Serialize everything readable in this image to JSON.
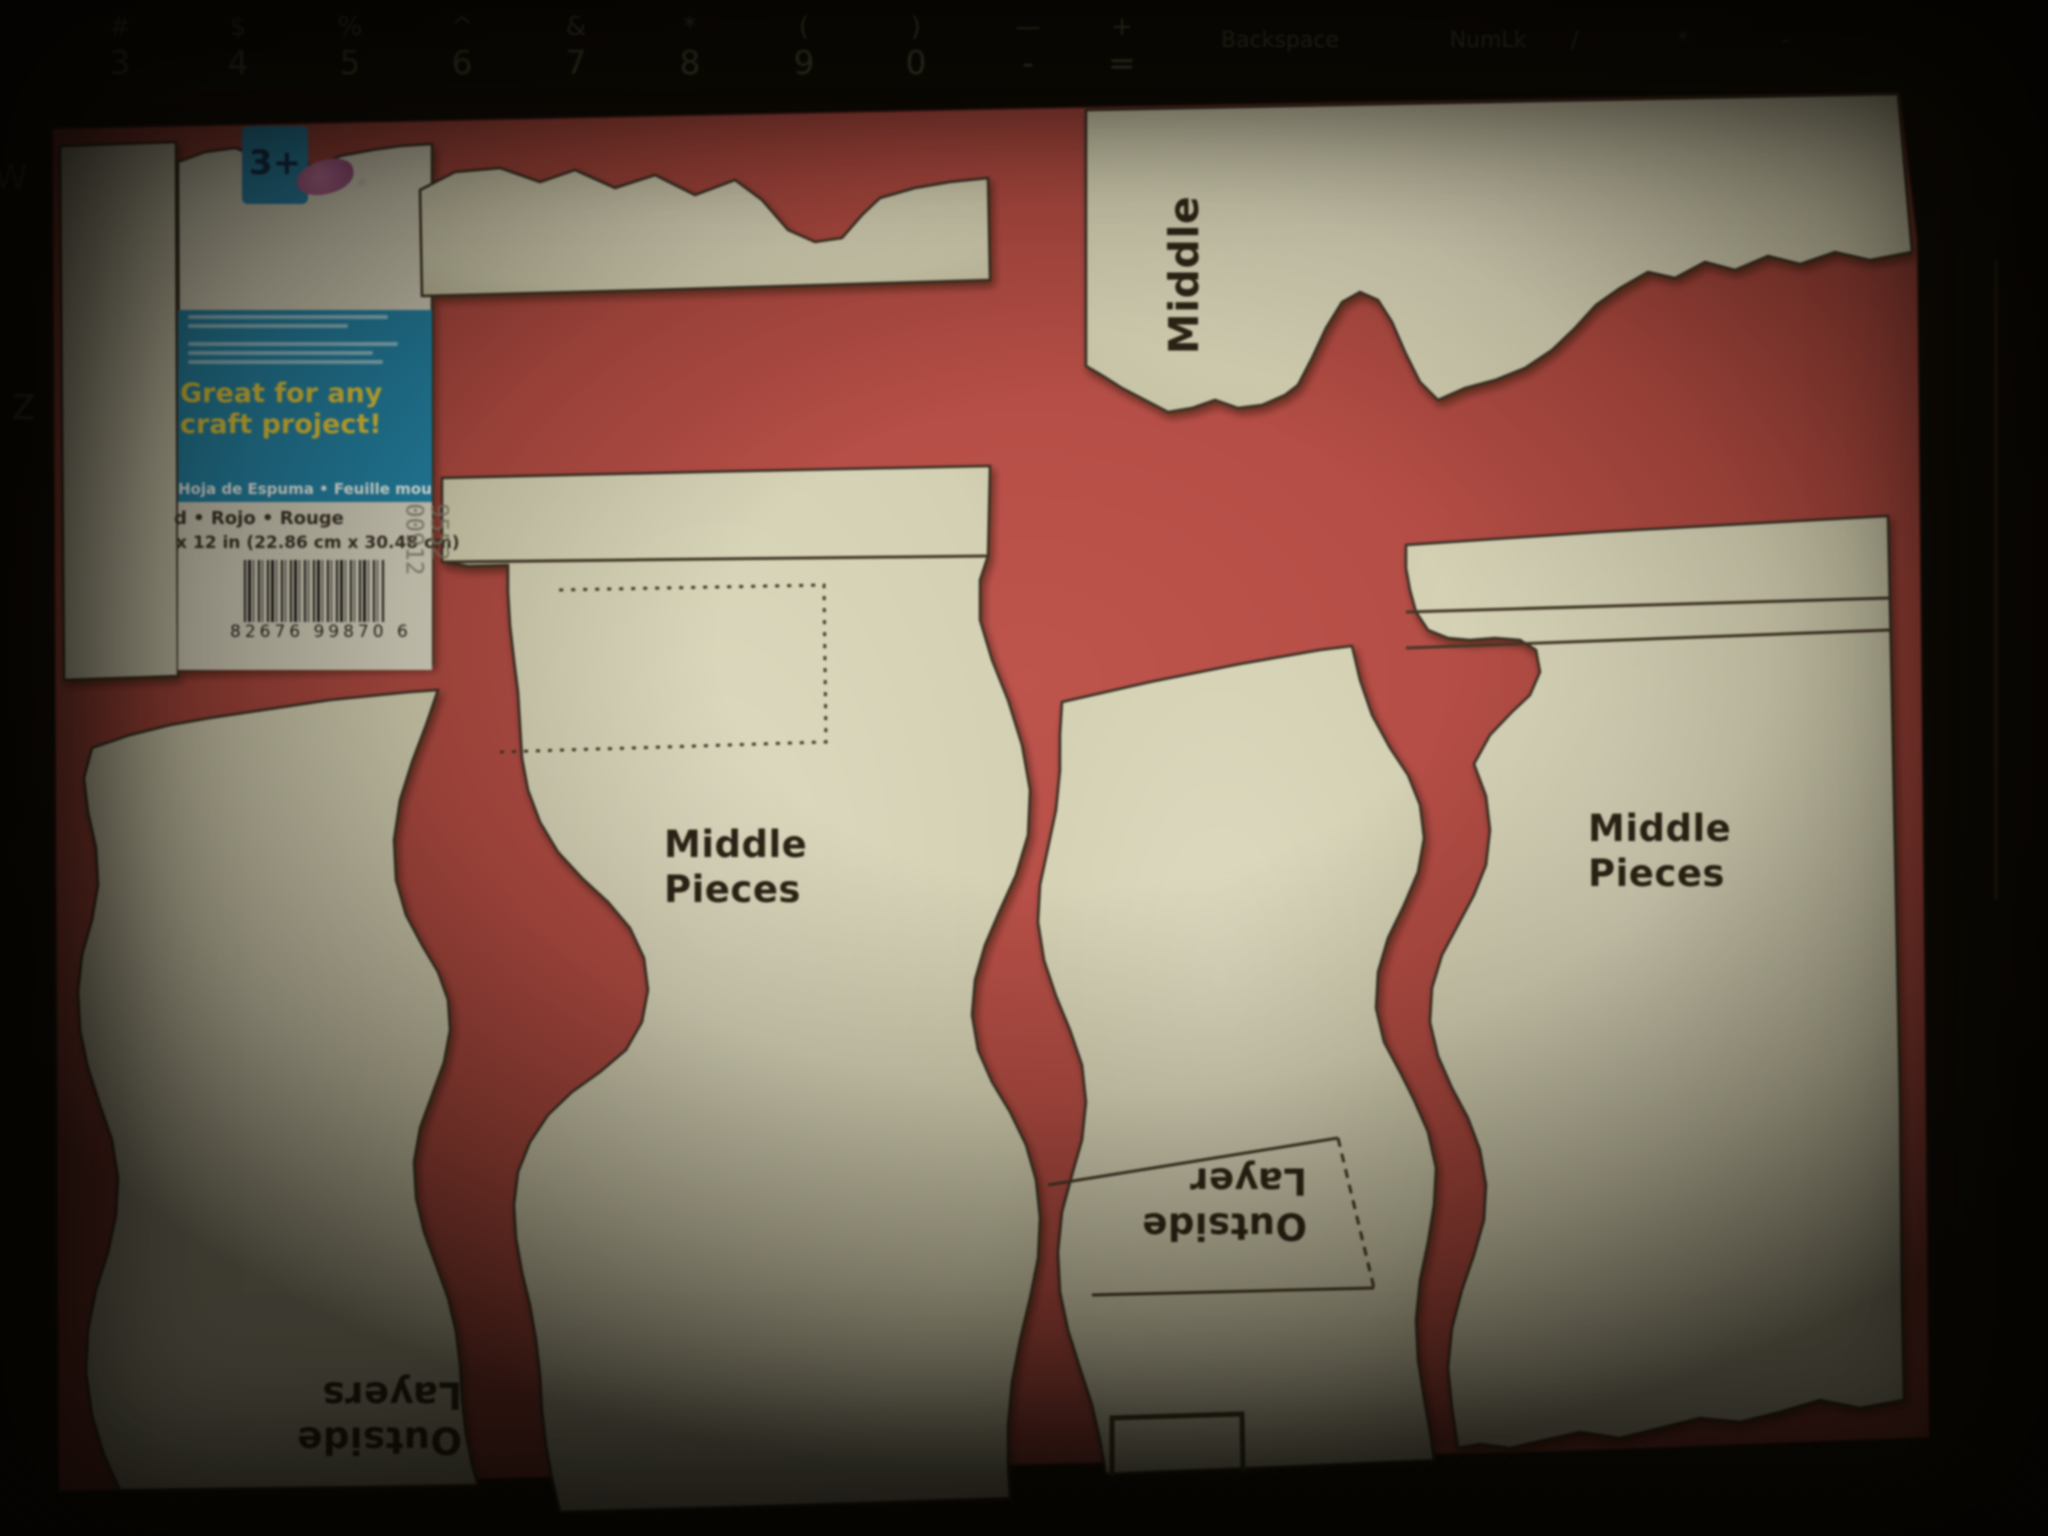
{
  "keyboard": {
    "keys": [
      {
        "sym": "#",
        "num": "3"
      },
      {
        "sym": "$",
        "num": "4"
      },
      {
        "sym": "%",
        "num": "5"
      },
      {
        "sym": "^",
        "num": "6"
      },
      {
        "sym": "&",
        "num": "7"
      },
      {
        "sym": "*",
        "num": "8"
      },
      {
        "sym": "(",
        "num": "9"
      },
      {
        "sym": ")",
        "num": "0"
      },
      {
        "sym": "—",
        "num": "-"
      },
      {
        "sym": "+",
        "num": "="
      }
    ],
    "wide_keys": [
      {
        "label": "Backspace"
      },
      {
        "label": "NumLk"
      },
      {
        "label": "/"
      },
      {
        "label": "*"
      },
      {
        "label": "-"
      }
    ],
    "side_letters": [
      {
        "label": "W"
      },
      {
        "label": "Z"
      }
    ]
  },
  "label_card": {
    "age_badge": "3+",
    "registered_mark": "®",
    "headline_line1": "Great for any",
    "headline_line2": "craft project!",
    "languages_line": "Hoja de Espuma  •  Feuille mousse",
    "color_line": "d  •  Rojo  •  Rouge",
    "size_line": "x 12 in (22.86 cm x 30.48 cm)",
    "barcode_digits": "82676 99870   6",
    "stock_number": "9552\n00912"
  },
  "pattern_labels": {
    "middle_vertical": "Middle",
    "middle_pieces_left": "Middle Pieces",
    "middle_pieces_right": "Middle Pieces",
    "outside_layers": "Outside Layers",
    "outside_layer": "Outside Layer"
  },
  "colors": {
    "foam_red": "#b5473e",
    "paper_cream": "#dad6b8",
    "label_blue": "#1b86ad",
    "headline_yellow": "#e8ca32",
    "outline_dark": "#382e20",
    "background_black": "#0b0a06"
  }
}
